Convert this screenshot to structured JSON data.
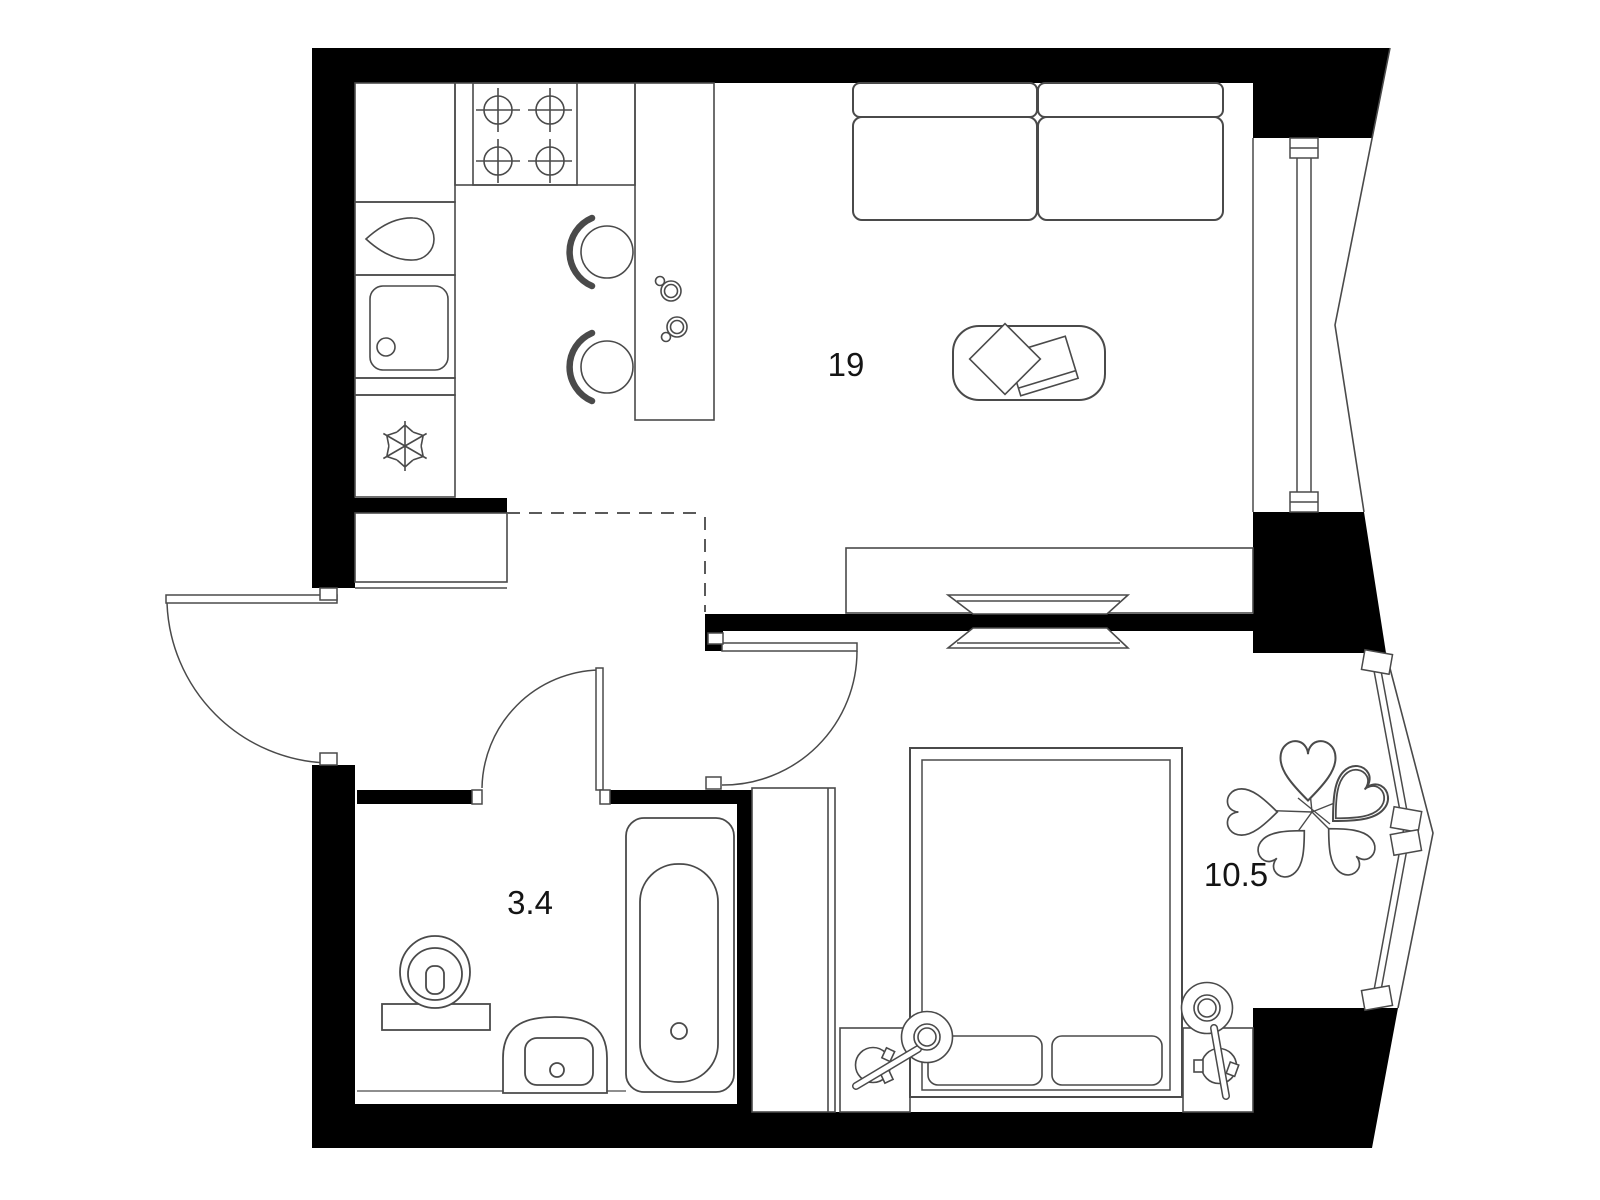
{
  "plan": {
    "type": "apartment-floor-plan",
    "background": "#ffffff",
    "colors": {
      "wall_fill": "#000000",
      "line": "#4a4a4a",
      "label_text": "#141414",
      "dashed_line": "#5a5a5a"
    },
    "rooms": [
      {
        "name": "living-room-kitchen",
        "area_label": "19"
      },
      {
        "name": "bathroom",
        "area_label": "3.4"
      },
      {
        "name": "bedroom",
        "area_label": "10.5"
      }
    ],
    "furniture_icons": [
      "stove-burners-icon",
      "kitchen-sink-icon",
      "fridge-snowflake-icon",
      "kettle-icon",
      "bar-counter",
      "bar-stool-icon",
      "cup-icon",
      "sofa",
      "coffee-table",
      "books-icon",
      "tv-console",
      "tv-icon",
      "entrance-door",
      "bathroom-door",
      "bedroom-door",
      "toilet-icon",
      "washbasin-icon",
      "bathtub-icon",
      "wardrobe",
      "double-bed",
      "pillow-icon",
      "nightstand",
      "bedside-lamp-icon",
      "plant-icon",
      "window",
      "wall"
    ]
  }
}
